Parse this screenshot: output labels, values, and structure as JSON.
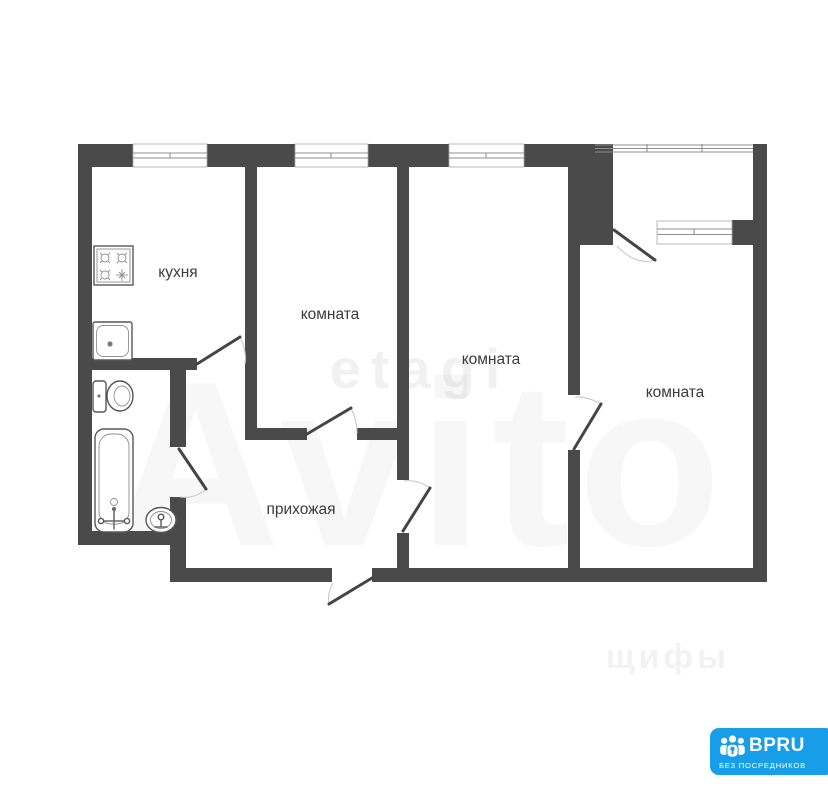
{
  "plan": {
    "rooms": [
      {
        "id": "kitchen",
        "label": "кухня"
      },
      {
        "id": "room-1",
        "label": "комната"
      },
      {
        "id": "room-2",
        "label": "комната"
      },
      {
        "id": "room-3",
        "label": "комната"
      },
      {
        "id": "hallway",
        "label": "прихожая"
      }
    ],
    "fixtures": [
      "stove-icon",
      "kitchen-sink-icon",
      "toilet-icon",
      "bathtub-icon",
      "washbasin-icon"
    ],
    "windows_count": 4,
    "doors_count": 7
  },
  "watermarks": {
    "large": "Avito",
    "agency": "etagi",
    "corner": "щифы"
  },
  "badge": {
    "title": "BPRU",
    "subtitle": "БЕЗ ПОСРЕДНИКОВ"
  },
  "colors": {
    "wall": "#4a4a4a",
    "badge": "#189de8",
    "label": "#3b3b3b"
  }
}
